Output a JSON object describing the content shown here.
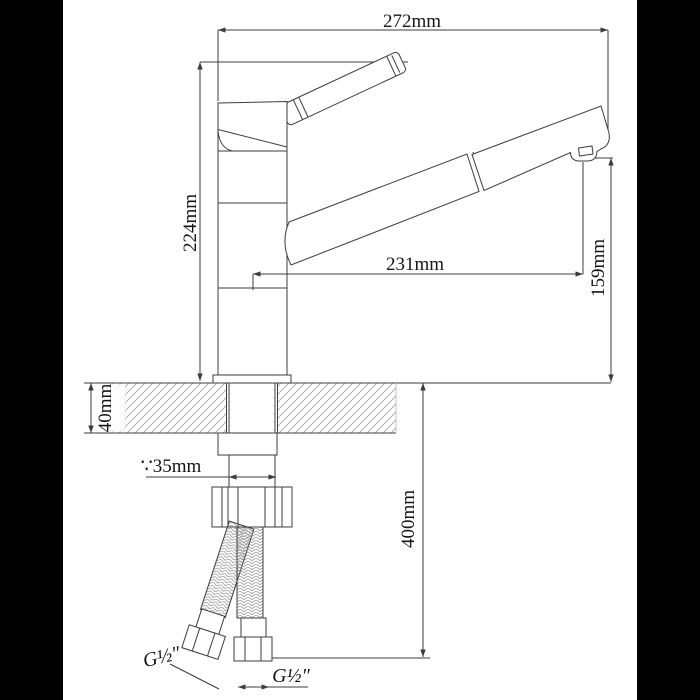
{
  "drawing": {
    "subject": "Pull-out kitchen faucet installation dimension drawing",
    "units": "mm",
    "labels": {
      "overall_width": "272mm",
      "height_to_handle": "224mm",
      "spout_reach": "231mm",
      "spout_outlet_height": "159mm",
      "deck_thickness": "40mm",
      "hole_diameter": "∵35mm",
      "hose_drop": "400mm",
      "thread_left": "G½″",
      "thread_right": "G½″"
    },
    "colors": {
      "line": "#3c3c3c",
      "background": "#ffffff",
      "letterbox": "#000000",
      "hatch": "#909090",
      "braid": "#8a8a8a"
    }
  }
}
